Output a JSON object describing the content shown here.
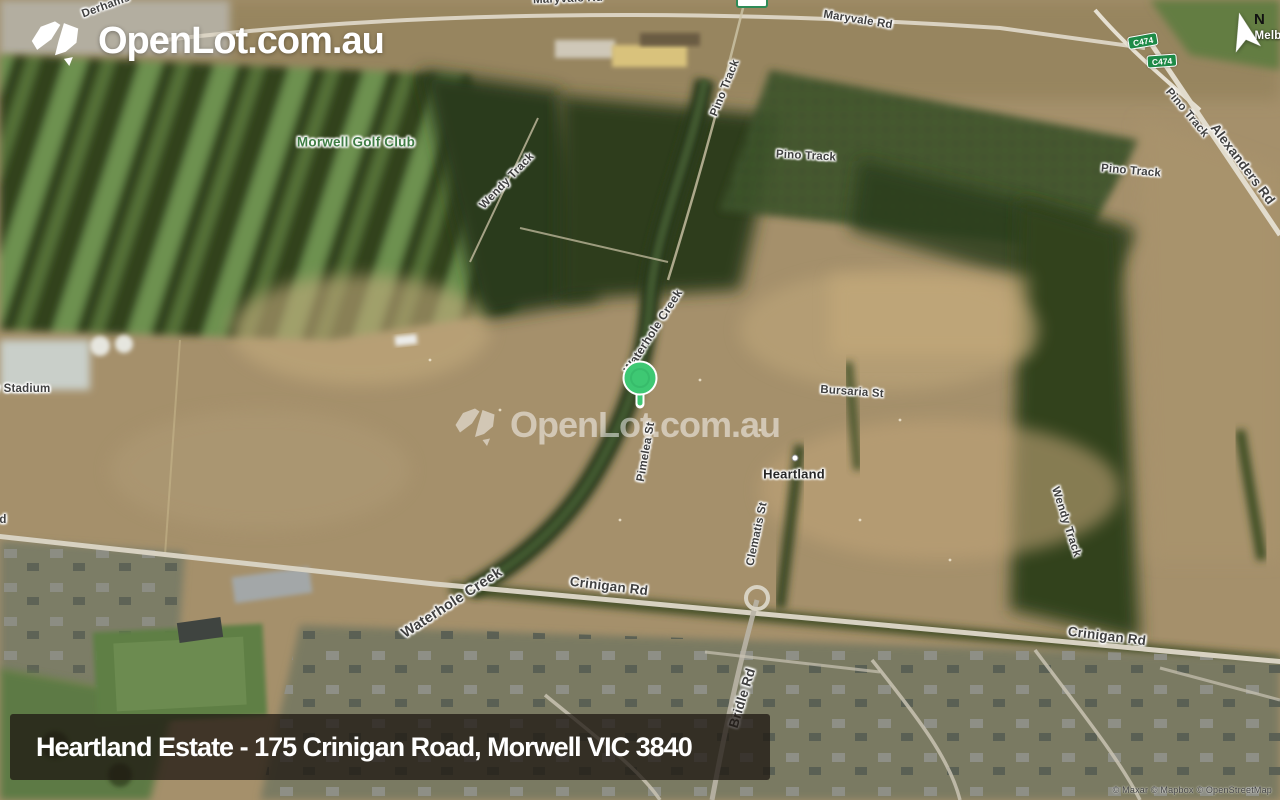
{
  "logo": {
    "brand": "OpenLot.com.au"
  },
  "watermark": {
    "brand": "OpenLot.com.au"
  },
  "compass": {
    "north": "N"
  },
  "marker": {
    "color": "#3ec873"
  },
  "banner": {
    "title": "Heartland Estate - 175 Crinigan Road, Morwell VIC 3840"
  },
  "attribution": {
    "text": "© Maxar © Mapbox © OpenStreetMap"
  },
  "route_shields": [
    {
      "label": "C474"
    },
    {
      "label": "C474"
    }
  ],
  "map_labels": [
    {
      "text": "Derhams"
    },
    {
      "text": "Maryvale Rd"
    },
    {
      "text": "Maryvale Rd"
    },
    {
      "text": "Pino Track"
    },
    {
      "text": "Pino Track"
    },
    {
      "text": "Pino Track"
    },
    {
      "text": "Pino Track"
    },
    {
      "text": "Alexanders Rd"
    },
    {
      "text": "Wendy Track"
    },
    {
      "text": "Morwell Golf Club"
    },
    {
      "text": "Waterhole Creek"
    },
    {
      "text": "Pimelea St"
    },
    {
      "text": "Bursaria St"
    },
    {
      "text": "Heartland"
    },
    {
      "text": "Clematis St"
    },
    {
      "text": "Waterhole Creek"
    },
    {
      "text": "Crinigan Rd"
    },
    {
      "text": "Crinigan Rd"
    },
    {
      "text": "Bridle Rd"
    },
    {
      "text": "y Stadium"
    },
    {
      "text": "Melb"
    },
    {
      "text": "d"
    },
    {
      "text": "Wendy Track"
    }
  ]
}
